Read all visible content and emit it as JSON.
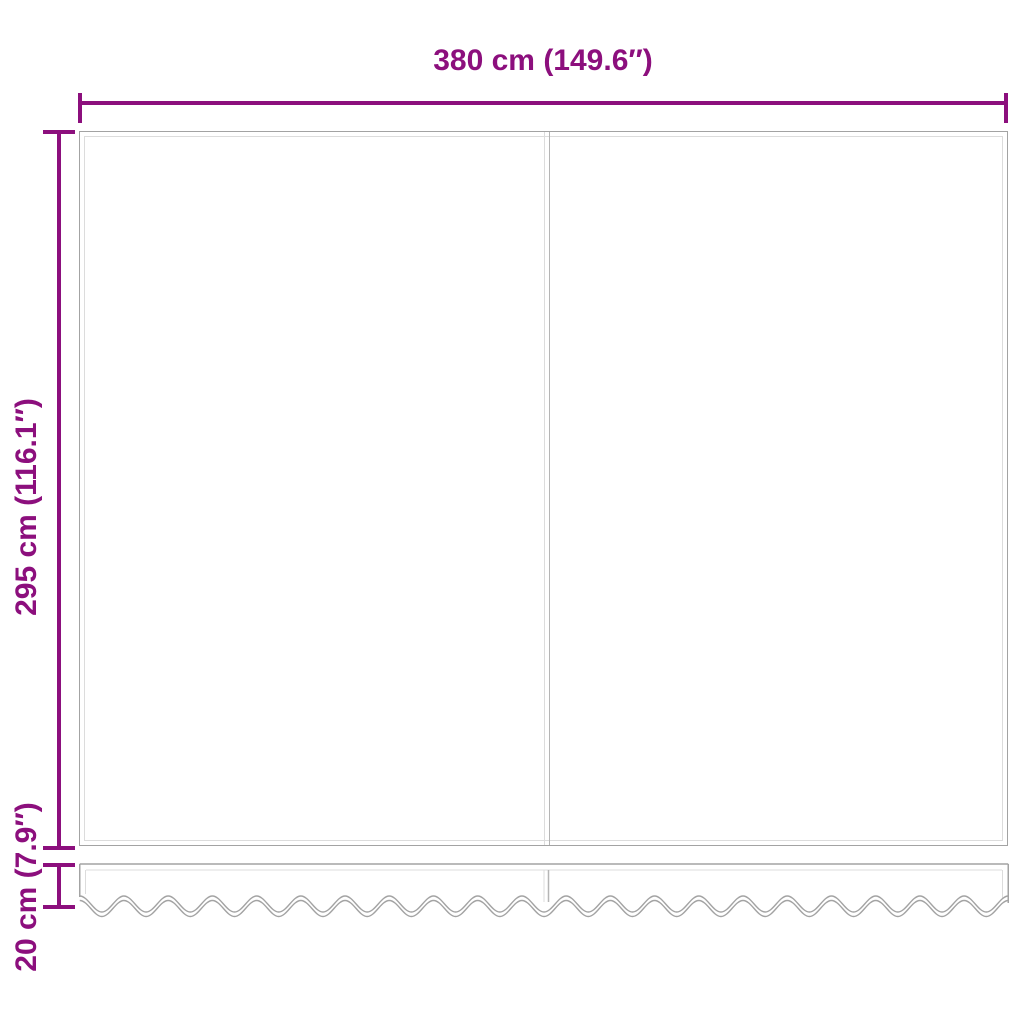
{
  "dimensions": {
    "width_label": "380 cm (149.6″)",
    "height_label": "295 cm (116.1″)",
    "valance_height_label": "20 cm (7.9″)"
  },
  "colors": {
    "dimension_accent": "#8c0f7d",
    "outline_dark": "#a3a3a3",
    "outline_light": "#dcdcdc",
    "seam_dark": "#b5b5b5",
    "background": "#ffffff"
  }
}
